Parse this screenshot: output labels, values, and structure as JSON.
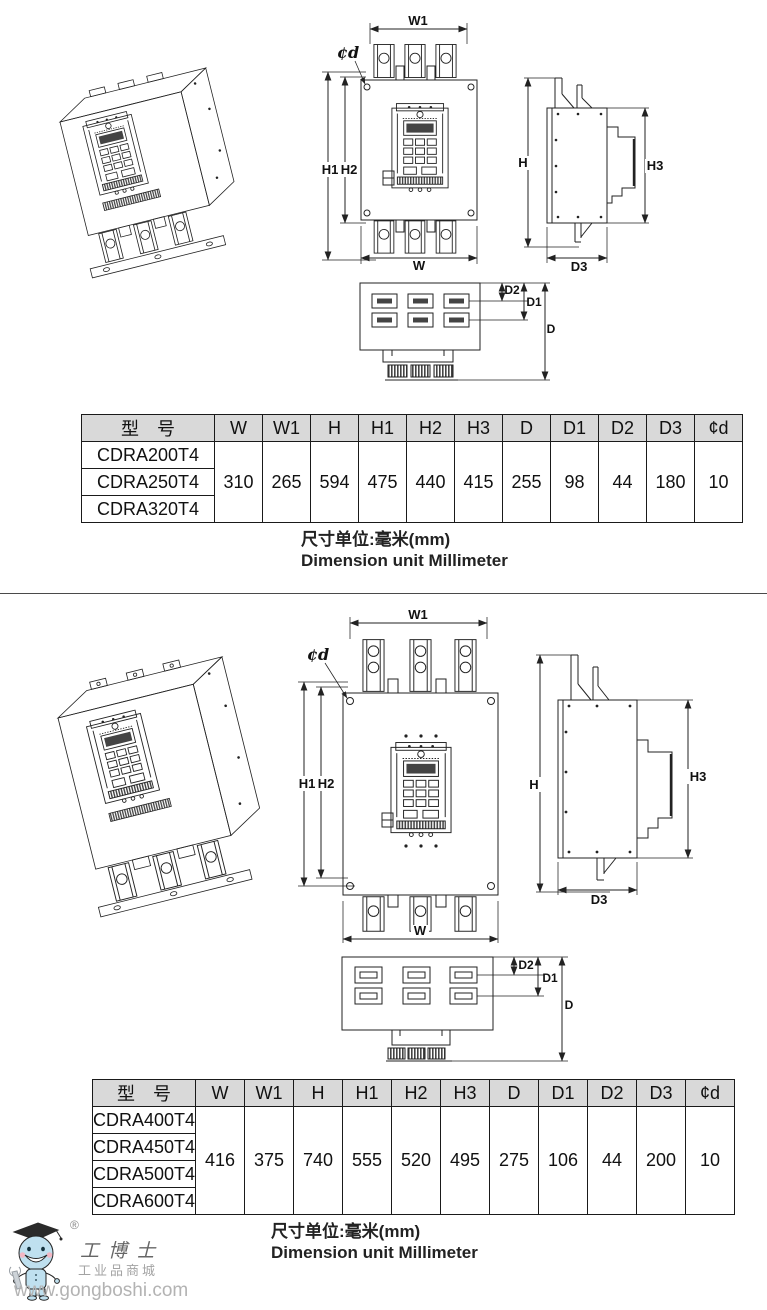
{
  "drawings": {
    "labels": {
      "w1": "W1",
      "phi_d": "¢d",
      "h1": "H1",
      "h2": "H2",
      "w": "W",
      "h": "H",
      "h3": "H3",
      "d3": "D3",
      "d2": "D2",
      "d1": "D1",
      "d": "D"
    }
  },
  "tables": [
    {
      "header": [
        "型　号",
        "W",
        "W1",
        "H",
        "H1",
        "H2",
        "H3",
        "D",
        "D1",
        "D2",
        "D3",
        "¢d"
      ],
      "models": [
        "CDRA200T4",
        "CDRA250T4",
        "CDRA320T4"
      ],
      "values": [
        "310",
        "265",
        "594",
        "475",
        "440",
        "415",
        "255",
        "98",
        "44",
        "180",
        "10"
      ]
    },
    {
      "header": [
        "型　号",
        "W",
        "W1",
        "H",
        "H1",
        "H2",
        "H3",
        "D",
        "D1",
        "D2",
        "D3",
        "¢d"
      ],
      "models": [
        "CDRA400T4",
        "CDRA450T4",
        "CDRA500T4",
        "CDRA600T4"
      ],
      "values": [
        "416",
        "375",
        "740",
        "555",
        "520",
        "495",
        "275",
        "106",
        "44",
        "200",
        "10"
      ]
    }
  ],
  "unit_note": {
    "zh": "尺寸单位:毫米(mm)",
    "en": "Dimension unit Millimeter"
  },
  "footer": {
    "brand": "工博士",
    "registered": "®",
    "subtitle": "工业品商城",
    "url": "www.gongboshi.com"
  }
}
